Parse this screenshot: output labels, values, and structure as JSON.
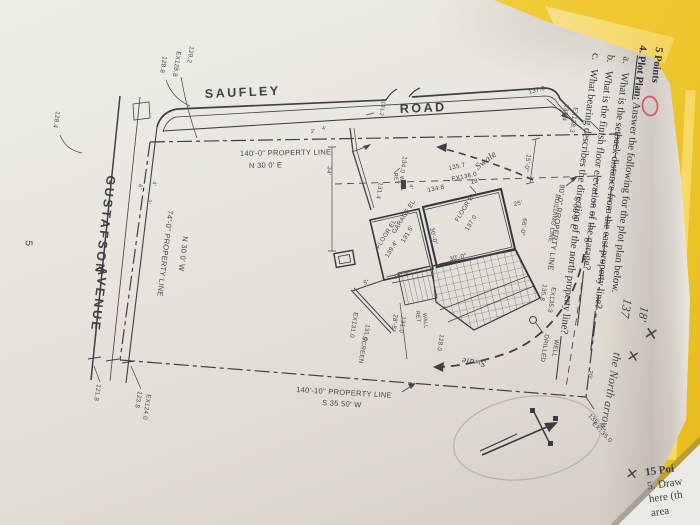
{
  "page": {
    "number": "5"
  },
  "questions": {
    "points": "5 Points",
    "q4_num": "4.",
    "q4_title": "Plot Plan:",
    "q4_text": " Answer the following for the plot plan below.",
    "a_num": "a.",
    "a_text": "What is the setback distance from the east property line?",
    "b_num": "b.",
    "b_text": "What is the finish floor elevation of the garage?",
    "c_num": "c.",
    "c_text": "What bearing describes the direction of the north property line?"
  },
  "handwriting": {
    "answer_a": "18'",
    "answer_b": "137",
    "note_c": "the North arrow",
    "x_mark": "✕"
  },
  "streets": {
    "saufley": "SAUFLEY",
    "road": "ROAD",
    "gustafson": "GUSTAFSON",
    "avenue": "AVENUE"
  },
  "property": {
    "north_len": "140'-0\" PROPERTY LINE",
    "north_brg": "N 30 0' E",
    "west_len": "74'-0\" PROPERTY LINE",
    "west_brg": "N 30 0' W",
    "east_len": "90'-0\" PROPERTY LINE",
    "east_brg": "S 60 0' E",
    "south_len": "140'-10\" PROPERTY LINE",
    "south_brg": "S 35 50' W",
    "building_line": "BUILDING LINE"
  },
  "labels": {
    "floor_el": "FLOOR EL",
    "floor_el_val": "137.0",
    "garage_el": "GARAGE EL",
    "garage_el_val": "131.5'",
    "floor2_el": "FLOOR EL",
    "floor2_el_val": "139.4'",
    "ret": "RET",
    "wall": "WALL",
    "screen": "SCREEN",
    "drilled": "DRILLED",
    "well": "WELL",
    "swale": "Swale"
  },
  "dims": {
    "d15": "15'-0\"",
    "d25": "25'",
    "d66": "66'-0\"",
    "d20": "20'",
    "d30": "30'-0\"",
    "d18": "18'-0\"",
    "d5": "5'",
    "d34": "34'",
    "d28": "28'-5\"",
    "d18b": "18'",
    "t6": "6'",
    "t4": "4'",
    "t2": "2'"
  },
  "elev": {
    "e1": "128.8",
    "e2": "EX128.8",
    "e3": "129.2",
    "e4": "128.4",
    "e5": "121.8",
    "e6": "123.8",
    "e7": "EX124.0",
    "e8": "131.2",
    "e9": "137.8",
    "e10": "137.4",
    "e11": "EX138.3",
    "e12": "135.7",
    "e13": "EX136.0",
    "e14": "134.8",
    "e15": "134.0",
    "e16": "131.4",
    "e17": "135.8",
    "e18": "EX135.3",
    "e19": "135.3",
    "e20": "EX135.0",
    "e21": "131.0",
    "e22": "128.0",
    "e23": "EX131.0",
    "e24": "131.0",
    "e25": "4'"
  },
  "sheet2": {
    "l1": "15 Poi",
    "l2": "5. Draw",
    "l3": "here (th",
    "l4": "area"
  },
  "colors": {
    "folder": "#eec72e",
    "desk": "#ac8a55",
    "red": "#c84054",
    "pencil": "#7c7c84",
    "ink": "#45464b"
  }
}
